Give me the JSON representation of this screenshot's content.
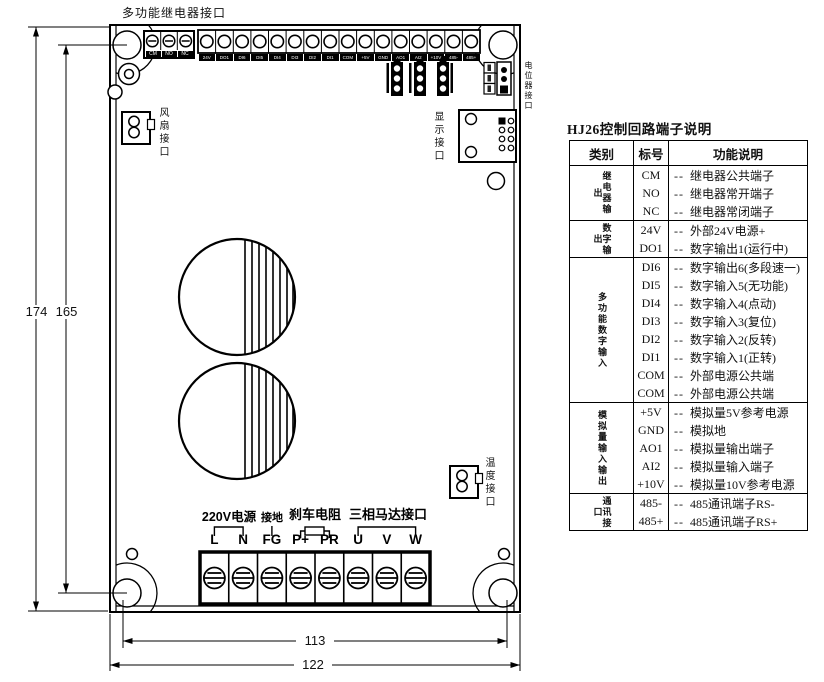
{
  "diagram": {
    "top_label": "多功能继电器接口",
    "relay_terminals": [
      "CM",
      "NO",
      "NC"
    ],
    "io_terminals": [
      "24V",
      "DO1",
      "DI6",
      "DI5",
      "DI4",
      "DI3",
      "DI2",
      "DI1",
      "COM",
      "+5V",
      "GND",
      "AO1",
      "AI2",
      "+10V",
      "485-",
      "485+"
    ],
    "connector_labels": {
      "fan": "风扇接口",
      "display": "显示接口",
      "pot": "电位器接口",
      "temp": "温度接口"
    },
    "bottom_group_labels": {
      "power": "220V电源",
      "ground": "接地",
      "brake": "刹车电阻",
      "motor": "三相马达接口"
    },
    "bottom_terminals": [
      "L",
      "N",
      "FG",
      "P+",
      "PR",
      "U",
      "V",
      "W"
    ],
    "dimensions": {
      "overall_height": "174",
      "hole_height": "165",
      "hole_width": "113",
      "overall_width": "122"
    }
  },
  "table": {
    "title": "HJ26控制回路端子说明",
    "headers": [
      "类别",
      "标号",
      "功能说明"
    ],
    "dash": "--",
    "groups": [
      {
        "category": "继电器输出",
        "rows": [
          {
            "id": "CM",
            "desc": "继电器公共端子"
          },
          {
            "id": "NO",
            "desc": "继电器常开端子"
          },
          {
            "id": "NC",
            "desc": "继电器常闭端子"
          }
        ]
      },
      {
        "category": "数字输出",
        "rows": [
          {
            "id": "24V",
            "desc": "外部24V电源+"
          },
          {
            "id": "DO1",
            "desc": "数字输出1(运行中)"
          }
        ]
      },
      {
        "category": "多功能数字输入",
        "rows": [
          {
            "id": "DI6",
            "desc": "数字输出6(多段速一)"
          },
          {
            "id": "DI5",
            "desc": "数字输入5(无功能)"
          },
          {
            "id": "DI4",
            "desc": "数字输入4(点动)"
          },
          {
            "id": "DI3",
            "desc": "数字输入3(复位)"
          },
          {
            "id": "DI2",
            "desc": "数字输入2(反转)"
          },
          {
            "id": "DI1",
            "desc": "数字输入1(正转)"
          },
          {
            "id": "COM",
            "desc": "外部电源公共端"
          },
          {
            "id": "COM",
            "desc": "外部电源公共端"
          }
        ]
      },
      {
        "category": "模拟量输入输出",
        "rows": [
          {
            "id": "+5V",
            "desc": "模拟量5V参考电源"
          },
          {
            "id": "GND",
            "desc": "模拟地"
          },
          {
            "id": "AO1",
            "desc": "模拟量输出端子"
          },
          {
            "id": "AI2",
            "desc": "模拟量输入端子"
          },
          {
            "id": "+10V",
            "desc": "模拟量10V参考电源"
          }
        ]
      },
      {
        "category": "通讯接口",
        "rows": [
          {
            "id": "485-",
            "desc": "485通讯端子RS-"
          },
          {
            "id": "485+",
            "desc": "485通讯端子RS+"
          }
        ]
      }
    ]
  }
}
